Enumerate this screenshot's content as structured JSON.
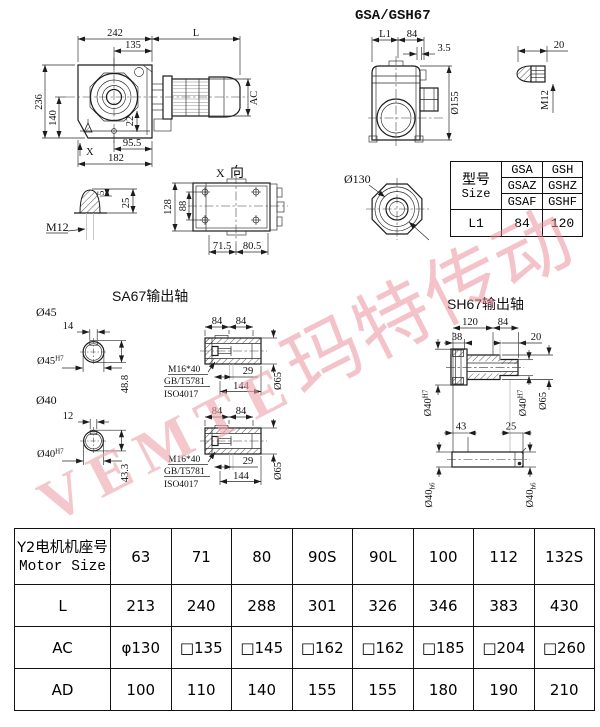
{
  "colors": {
    "line": "#1c1c1c",
    "watermark_pink": "#e9879a"
  },
  "watermark": {
    "latin": "VEMTE",
    "cjk": "玛特传动"
  },
  "titles": {
    "side": "GSA/GSH67",
    "sa67": "SA67输出轴",
    "sh67": "SH67输出轴",
    "xv_x": "X",
    "xv_dir": "向"
  },
  "main_view": {
    "d242": "242",
    "dL": "L",
    "d135": "135",
    "d236": "236",
    "d140": "140",
    "d22": "22",
    "d95": "95.5",
    "d182": "182",
    "dX": "X",
    "dAC": "AC"
  },
  "side_view": {
    "dL1": "L1",
    "d84": "84",
    "d35": "3.5",
    "d155": "Ø155"
  },
  "key_detail": {
    "d20": "20",
    "m12": "M12"
  },
  "plug_detail": {
    "d5": "5",
    "d25": "25",
    "m12": "M12"
  },
  "x_view": {
    "d128": "128",
    "d88": "88",
    "d715": "71.5",
    "d805": "80.5"
  },
  "octagon": {
    "d130": "Ø130"
  },
  "size_table": {
    "type_cn": "型号",
    "type_en": "Size",
    "rows": [
      [
        "GSA",
        "GSH"
      ],
      [
        "GSAZ",
        "GSHZ"
      ],
      [
        "GSAF",
        "GSHF"
      ]
    ],
    "l1": "L1",
    "v1": "84",
    "v2": "120"
  },
  "sa67": {
    "shaft45": {
      "label": "Ø45",
      "key_w": "14",
      "bore": "Ø45",
      "bore_fit": "H7",
      "depth": "48.8"
    },
    "shaft40": {
      "label": "Ø40",
      "key_w": "12",
      "bore": "Ø40",
      "bore_fit": "H7",
      "depth": "43.3"
    },
    "sec1": {
      "d84a": "84",
      "d84b": "84",
      "d29": "29",
      "d144": "144",
      "d65": "Ø65",
      "bolt": "M16*40",
      "std1": "GB/T5781",
      "std2": "ISO4017"
    },
    "sec2": {
      "d84a": "84",
      "d84b": "84",
      "d29": "29",
      "d144": "144",
      "d65": "Ø65",
      "bolt": "M16*40",
      "std1": "GB/T5781",
      "std2": "ISO4017"
    }
  },
  "sh67": {
    "d120": "120",
    "d84": "84",
    "d38": "38",
    "d20": "20",
    "d43": "43",
    "d25": "25",
    "d65": "Ø65",
    "boreL": "Ø40",
    "boreL_fit": "H7",
    "boreR": "Ø40",
    "boreR_fit": "H7",
    "shaftL": "Ø40",
    "shaftL_fit": "h6",
    "shaftR": "Ø40",
    "shaftR_fit": "h6"
  },
  "motor_table": {
    "header_cn": "Y2电机机座号",
    "header_en": "Motor Size",
    "sizes": [
      "63",
      "71",
      "80",
      "90S",
      "90L",
      "100",
      "112",
      "132S"
    ],
    "row_l_label": "L",
    "row_l": [
      "213",
      "240",
      "288",
      "301",
      "326",
      "346",
      "383",
      "430"
    ],
    "row_ac_label": "AC",
    "row_ac": [
      "φ130",
      "□135",
      "□145",
      "□162",
      "□162",
      "□185",
      "□204",
      "□260"
    ],
    "row_ad_label": "AD",
    "row_ad": [
      "100",
      "110",
      "140",
      "155",
      "155",
      "180",
      "190",
      "210"
    ]
  }
}
